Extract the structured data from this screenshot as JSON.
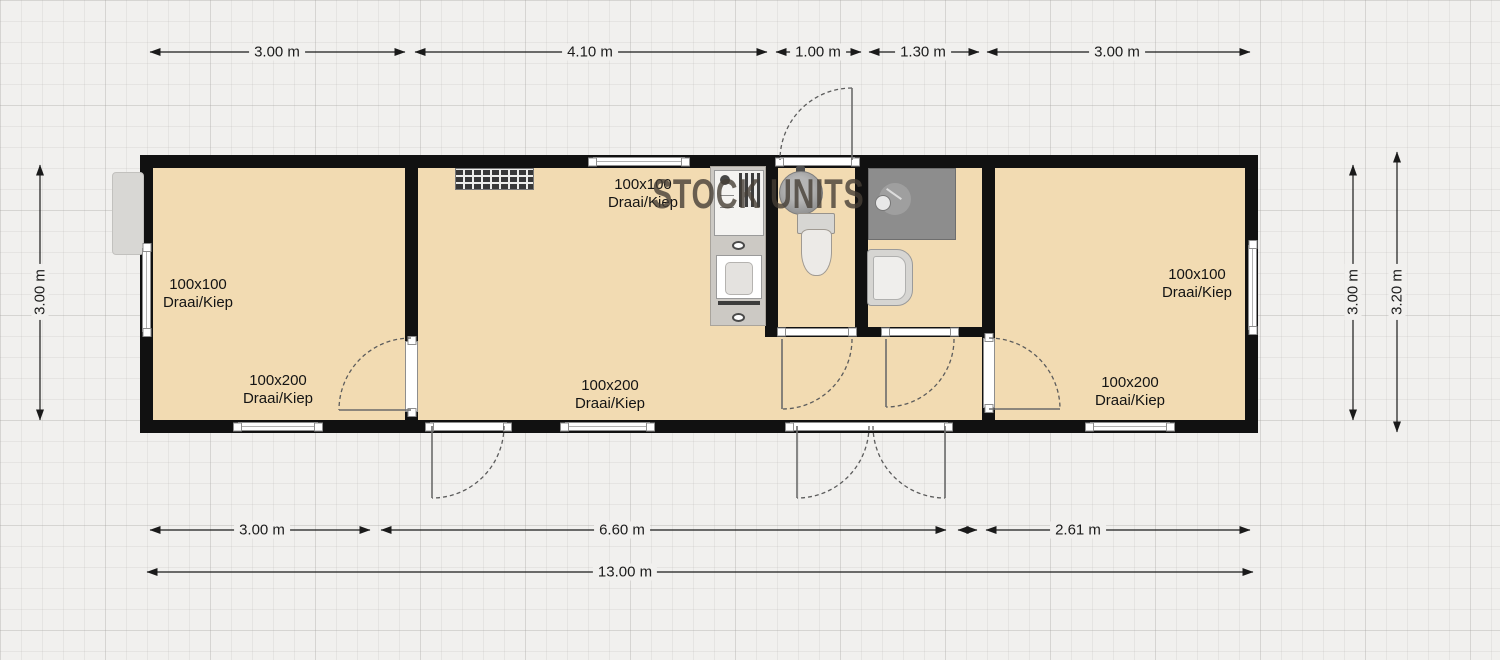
{
  "watermark": "STOCK UNITS",
  "dimensions": {
    "top": [
      "3.00 m",
      "4.10 m",
      "1.00 m",
      "1.30 m",
      "3.00 m"
    ],
    "bottom": [
      "3.00 m",
      "6.60 m",
      "2.61 m"
    ],
    "overall": "13.00 m",
    "left": "3.00 m",
    "right": [
      "3.00 m",
      "3.20 m"
    ]
  },
  "window_labels": [
    {
      "size": "100x100",
      "mode": "Draai/Kiep"
    },
    {
      "size": "100x200",
      "mode": "Draai/Kiep"
    },
    {
      "size": "100x100",
      "mode": "Draai/Kiep"
    },
    {
      "size": "100x200",
      "mode": "Draai/Kiep"
    },
    {
      "size": "100x100",
      "mode": "Draai/Kiep"
    },
    {
      "size": "100x200",
      "mode": "Draai/Kiep"
    }
  ],
  "fixtures": {
    "kitchen": "kitchen-counter-with-stove-and-sink",
    "radiator": "radiator-grille",
    "round_basin": "round-washbasin",
    "toilet": "toilet",
    "shower": "shower-cabin",
    "washbasin": "washbasin",
    "entrance": "double-entrance-door",
    "exterior_box": "exterior-utility-box"
  },
  "colors": {
    "floor": "#f2dbb2",
    "wall": "#111111",
    "paper": "#f1f0ee",
    "fixture_gray": "#8d8d8d"
  }
}
